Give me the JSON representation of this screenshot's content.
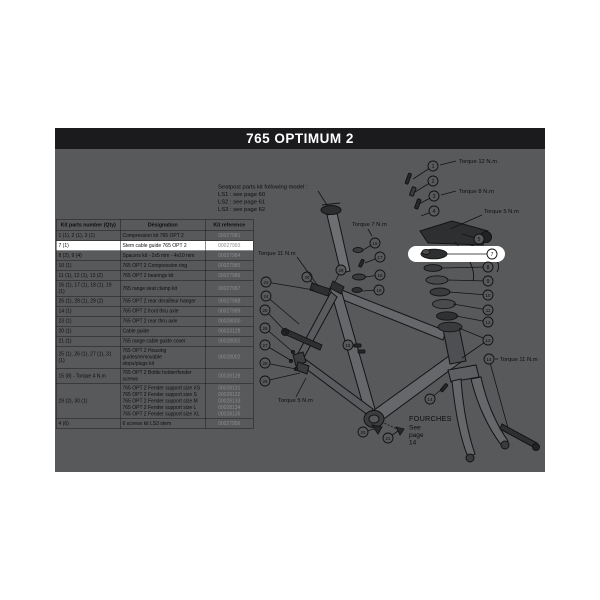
{
  "title": "765 OPTIMUM 2",
  "colors": {
    "title_bar_bg": "#1b1b1d",
    "title_text": "#ffffff",
    "panel_bg": "#58595b",
    "highlight_row_bg": "#ffffff",
    "line_color": "#141414",
    "reference_text": "#8d8e91"
  },
  "table": {
    "headers": [
      "Kit parts number (Qty)",
      "Désignation",
      "Kit reference"
    ],
    "rows": [
      {
        "parts": "1 (1), 2 (1), 3 (1)",
        "designations": [
          "Compression kit 765 OPT 2"
        ],
        "refs": [
          "00027981"
        ],
        "highlight": false
      },
      {
        "parts": "7 (1)",
        "designations": [
          "Stem cable guide 765 OPT 2"
        ],
        "refs": [
          "00027993"
        ],
        "highlight": true
      },
      {
        "parts": "8 (2), 9 (4)",
        "designations": [
          "Spacers kit - 2x5 mm - 4x10 mm"
        ],
        "refs": [
          "00027984"
        ],
        "highlight": false
      },
      {
        "parts": "10 (1)",
        "designations": [
          "765 OPT 2 Compression ring"
        ],
        "refs": [
          "00027985"
        ],
        "highlight": false
      },
      {
        "parts": "11 (1), 12 (1), 13 (2)",
        "designations": [
          "765 OPT 2 bearings kit"
        ],
        "refs": [
          "00027986"
        ],
        "highlight": false
      },
      {
        "parts": "16 (1), 17 (1), 18 (1), 19 (1)",
        "designations": [
          "765 range seat clamp kit"
        ],
        "refs": [
          "00027987"
        ],
        "highlight": false
      },
      {
        "parts": "26 (1), 28 (1), 29 (2)",
        "designations": [
          "765 OPT 2 rear derailleur hanger"
        ],
        "refs": [
          "00027988"
        ],
        "highlight": false
      },
      {
        "parts": "14 (1)",
        "designations": [
          "765 OPT 2 front thru axle"
        ],
        "refs": [
          "00027989"
        ],
        "highlight": false
      },
      {
        "parts": "23 (1)",
        "designations": [
          "765 OPT 2 rear thru axle"
        ],
        "refs": [
          "00028000"
        ],
        "highlight": false
      },
      {
        "parts": "20 (1)",
        "designations": [
          "Cable guide"
        ],
        "refs": [
          "00023128"
        ],
        "highlight": false
      },
      {
        "parts": "21 (1)",
        "designations": [
          "765 range cable guide cover"
        ],
        "refs": [
          "00028001"
        ],
        "highlight": false
      },
      {
        "parts": "25 (1), 26 (1), 27 (1), 31 (1)",
        "designations": [
          "765 OPT 2 Housing guides/removable",
          "stops/plugs kit"
        ],
        "refs": [
          "00028002"
        ],
        "highlight": false
      },
      {
        "parts": "15 (8) - Torque 4 N.m",
        "designations": [
          "765 OPT 2 Bottle holder/fender screws"
        ],
        "refs": [
          "00028128"
        ],
        "highlight": false
      },
      {
        "parts": "29 (2), 30 (1)",
        "designations": [
          "765 OPT 2 Fender support size XS",
          "765 OPT 2 Fender support size S",
          "765 OPT 2 Fender support size M",
          "765 OPT 2 Fender support size L",
          "765 OPT 2 Fender support size XL"
        ],
        "refs": [
          "00028131",
          "00028132",
          "00028133",
          "00028134",
          "00028135"
        ],
        "highlight": false
      },
      {
        "parts": "4 (6)",
        "designations": [
          "6 screws kit LS3 stem"
        ],
        "refs": [
          "00027956"
        ],
        "highlight": false
      }
    ]
  },
  "notes": {
    "seatpost": [
      "Seatpost parts kit following model :",
      "LS1 : see page 60",
      "LS2 : see page 61",
      "LS3 : see page 62"
    ],
    "fourches": [
      "FOURCHES",
      "See page 14"
    ]
  },
  "diagram": {
    "callouts": [
      {
        "n": "1",
        "x": 433,
        "y": 166,
        "tx": 413,
        "ty": 179
      },
      {
        "n": "2",
        "x": 433,
        "y": 181,
        "tx": 415,
        "ty": 192
      },
      {
        "n": "3",
        "x": 434,
        "y": 196,
        "tx": 419,
        "ty": 204
      },
      {
        "n": "4",
        "x": 434,
        "y": 211,
        "tx": 421,
        "ty": 216
      },
      {
        "n": "5",
        "x": 479,
        "y": 239,
        "tx": 462,
        "ty": 234
      },
      {
        "n": "7",
        "x": 492,
        "y": 254,
        "tx": 447,
        "ty": 254,
        "wh": true
      },
      {
        "n": "8",
        "x": 488,
        "y": 267,
        "tx": 441,
        "ty": 268
      },
      {
        "n": "9",
        "x": 488,
        "y": 281,
        "tx": 447,
        "ty": 280
      },
      {
        "n": "10",
        "x": 488,
        "y": 295,
        "tx": 449,
        "ty": 292
      },
      {
        "n": "11",
        "x": 488,
        "y": 310,
        "tx": 453,
        "ty": 304
      },
      {
        "n": "12",
        "x": 488,
        "y": 322,
        "tx": 456,
        "ty": 316
      },
      {
        "n": "13",
        "x": 488,
        "y": 340,
        "tx": 459,
        "ty": 328,
        "tx2": 462,
        "ty2": 358
      },
      {
        "n": "14",
        "x": 489,
        "y": 359,
        "tx": 508,
        "ty": 428
      },
      {
        "n": "16",
        "x": 375,
        "y": 243,
        "tx": 363,
        "ty": 250
      },
      {
        "n": "17",
        "x": 380,
        "y": 257,
        "tx": 365,
        "ty": 263
      },
      {
        "n": "18",
        "x": 380,
        "y": 275,
        "tx": 365,
        "ty": 277
      },
      {
        "n": "19",
        "x": 379,
        "y": 290,
        "tx": 362,
        "ty": 291
      },
      {
        "n": "30",
        "x": 307,
        "y": 277,
        "tx": 315,
        "ty": 285
      },
      {
        "n": "29",
        "x": 341,
        "y": 270,
        "tx": 335,
        "ty": 282
      },
      {
        "n": "23",
        "x": 266,
        "y": 282,
        "tx": 314,
        "ty": 290
      },
      {
        "n": "24",
        "x": 266,
        "y": 296,
        "tx": 299,
        "ty": 324
      },
      {
        "n": "25",
        "x": 265,
        "y": 310,
        "tx": 287,
        "ty": 333
      },
      {
        "n": "26",
        "x": 265,
        "y": 328,
        "tx": 293,
        "ty": 352
      },
      {
        "n": "27",
        "x": 265,
        "y": 345,
        "tx": 292,
        "ty": 361
      },
      {
        "n": "28",
        "x": 265,
        "y": 363,
        "tx": 296,
        "ty": 369
      },
      {
        "n": "29",
        "x": 265,
        "y": 381,
        "tx": 300,
        "ty": 373
      },
      {
        "n": "15",
        "x": 348,
        "y": 345,
        "tx": 357,
        "ty": 347
      },
      {
        "n": "20",
        "x": 363,
        "y": 432,
        "tx": 374,
        "ty": 429
      },
      {
        "n": "21",
        "x": 388,
        "y": 438,
        "tx": 398,
        "ty": 431
      },
      {
        "n": "14",
        "x": 430,
        "y": 399,
        "tx": 443,
        "ty": 388
      }
    ],
    "torque_labels": [
      {
        "text": "Torque 12 N.m",
        "x": 459,
        "y": 163,
        "lx1": 456,
        "ly1": 161,
        "lx2": 440,
        "ly2": 165
      },
      {
        "text": "Torque 8 N.m",
        "x": 459,
        "y": 193,
        "lx1": 456,
        "ly1": 191,
        "lx2": 441,
        "ly2": 195
      },
      {
        "text": "Torque 5 N.m",
        "x": 484,
        "y": 213,
        "lx1": 482,
        "ly1": 215,
        "lx2": 450,
        "ly2": 229
      },
      {
        "text": "Torque 7 N.m",
        "x": 352,
        "y": 226,
        "lx1": 368,
        "ly1": 229,
        "lx2": 372,
        "ly2": 236
      },
      {
        "text": "Torque 11 N.m",
        "x": 258,
        "y": 255,
        "lx1": 297,
        "ly1": 257,
        "lx2": 318,
        "ly2": 286
      },
      {
        "text": "Torque 11 N.m",
        "x": 500,
        "y": 361,
        "lx1": 498,
        "ly1": 359,
        "lx2": 495,
        "ly2": 359
      },
      {
        "text": "Torque 5 N.m",
        "x": 278,
        "y": 402,
        "lx1": 296,
        "ly1": 397,
        "lx2": 306,
        "ly2": 378
      }
    ]
  }
}
